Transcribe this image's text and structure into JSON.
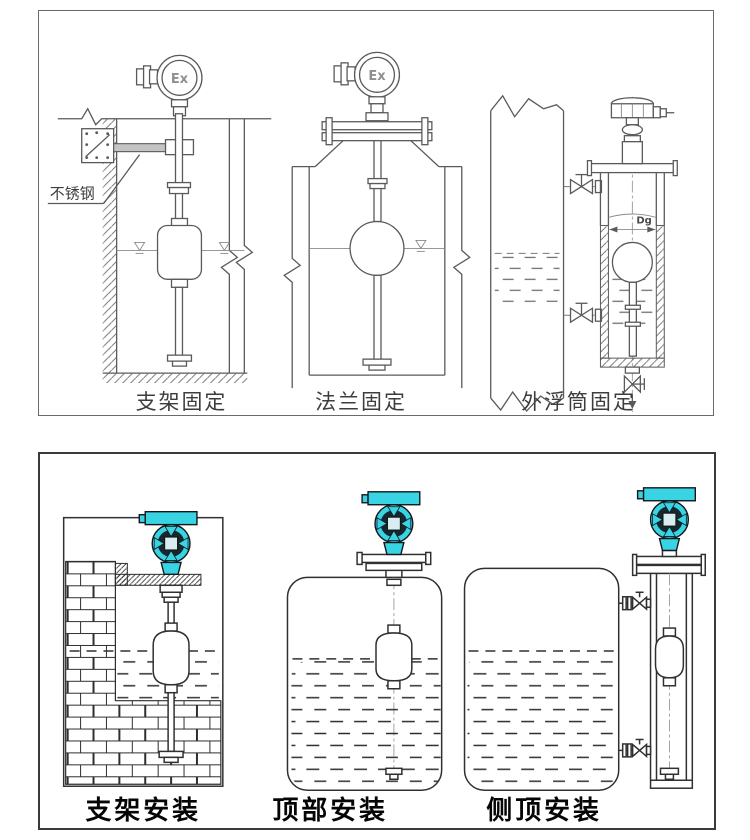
{
  "top_row": {
    "captions": [
      "支架固定",
      "法兰固定",
      "外浮筒固定"
    ],
    "stainless_steel_label": "不锈钢",
    "ex_marking": "Ex",
    "diameter_label": "Dg"
  },
  "bottom_row": {
    "captions": [
      "支架安装",
      "顶部安装",
      "侧顶安装"
    ]
  },
  "colors": {
    "transmitter": "#38d4e4",
    "transmitter_dark": "#14282e",
    "transmitter_center": "#d8edf0",
    "line_top": "#5a5a5a",
    "line_bottom": "#303030",
    "caption_top": "#3d3d3d",
    "caption_bottom": "#050505",
    "background": "#ffffff"
  }
}
